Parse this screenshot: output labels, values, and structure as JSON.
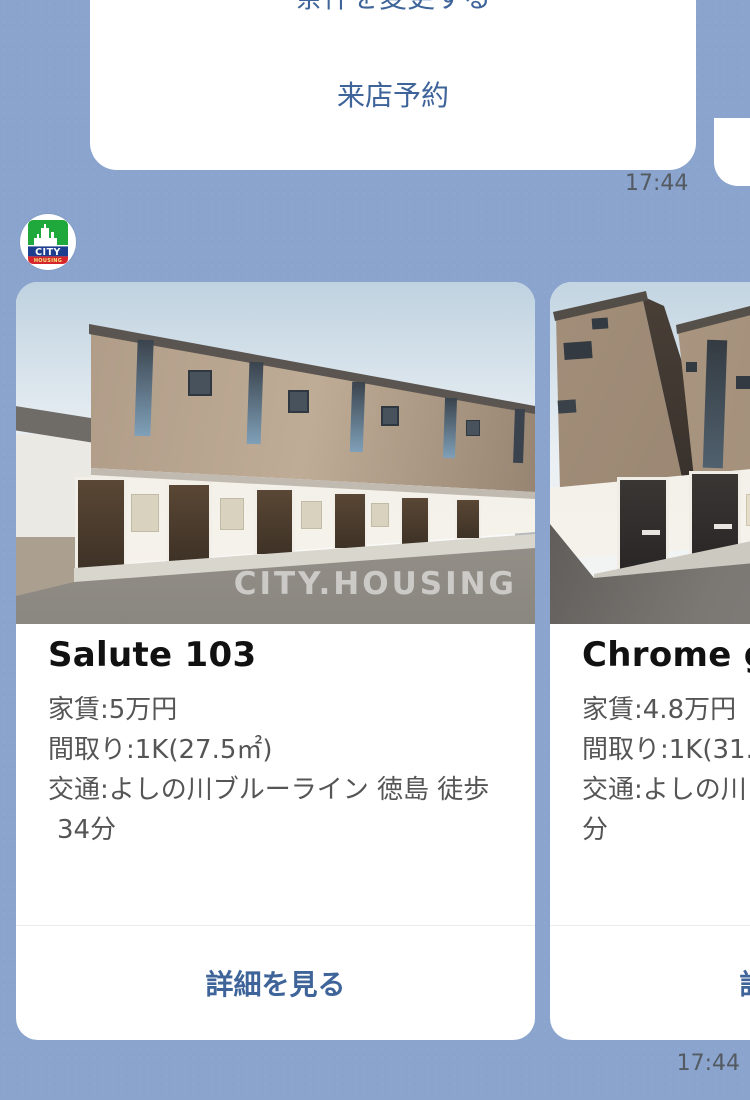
{
  "background_color": "#8AA4CE",
  "menu_bubble": {
    "button_top_label": "条件を変更する",
    "button_bottom_label": "来店予約",
    "timestamp": "17:44"
  },
  "avatar": {
    "brand_line1": "CITY",
    "brand_line2": "HOUSING"
  },
  "carousel": {
    "timestamp": "17:44",
    "cards": [
      {
        "title": "Salute 103",
        "details": [
          "家賃:5万円",
          "間取り:1K(27.5㎡)",
          "交通:よしの川ブルーライン 徳島 徒歩",
          "34分"
        ],
        "action_label": "詳細を見る",
        "watermark": "CITY.HOUSING"
      },
      {
        "title": "Chrome ga",
        "details": [
          "家賃:4.8万円",
          "間取り:1K(31.7",
          "交通:よしの川ブ",
          "分"
        ],
        "action_label": "詳細を見る"
      }
    ]
  },
  "colors": {
    "link_blue": "#3E6499",
    "title_black": "#111111",
    "detail_gray": "#555555",
    "timestamp_gray": "#545A61",
    "logo_green": "#1FA83C",
    "logo_navy": "#1D3E8F",
    "logo_red": "#D6252C"
  }
}
